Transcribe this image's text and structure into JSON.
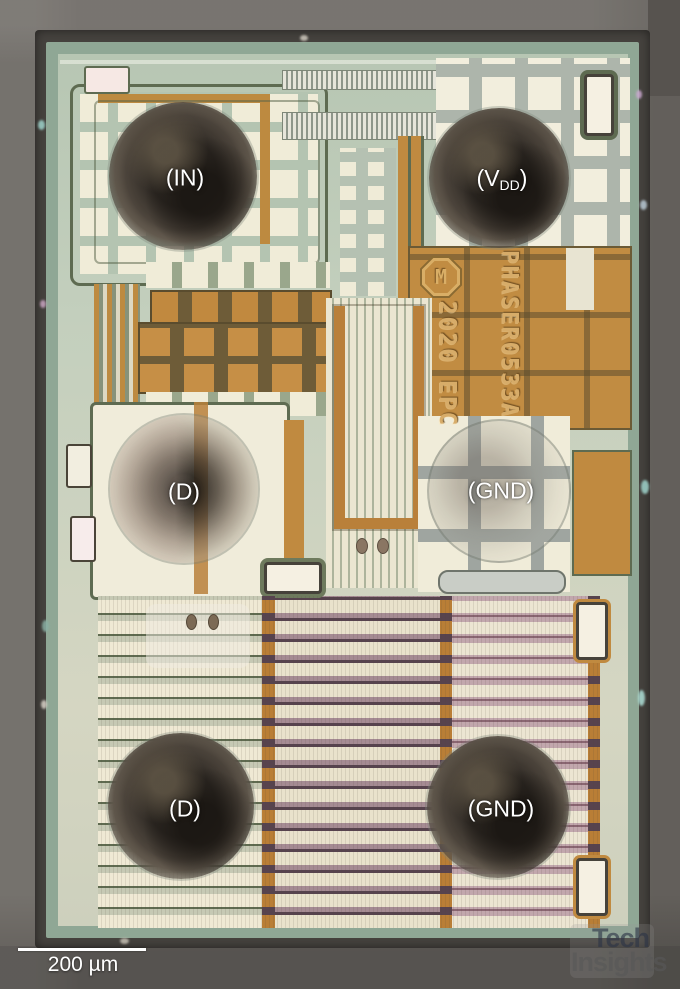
{
  "image": {
    "kind": "semiconductor die photograph",
    "background_gray": "#6e6a65"
  },
  "die": {
    "pad_labels": {
      "in": "(IN)",
      "vdd_pre": "(V",
      "vdd_sub": "DD",
      "vdd_post": ")",
      "drain_mid": "(D)",
      "gnd_mid": "(GND)",
      "drain_bottom": "(D)",
      "gnd_bottom": "(GND)"
    },
    "markings": {
      "logo_letter": "M",
      "date_code": "2020 EPC",
      "part_number": "PHASER0533A"
    },
    "colors": {
      "copper_metal": "#c18c42",
      "seal_ring_green": "#8fa795",
      "interior_sage": "#c3cfbd",
      "pad_cream": "#efead6",
      "bump_dark": "#2d2823",
      "stripe_olive": "#5f6b50",
      "stripe_mauve": "#8a6672"
    }
  },
  "scale_bar": {
    "label": "200 µm"
  },
  "watermark": {
    "line1": "Tech",
    "line2": "Insights"
  }
}
